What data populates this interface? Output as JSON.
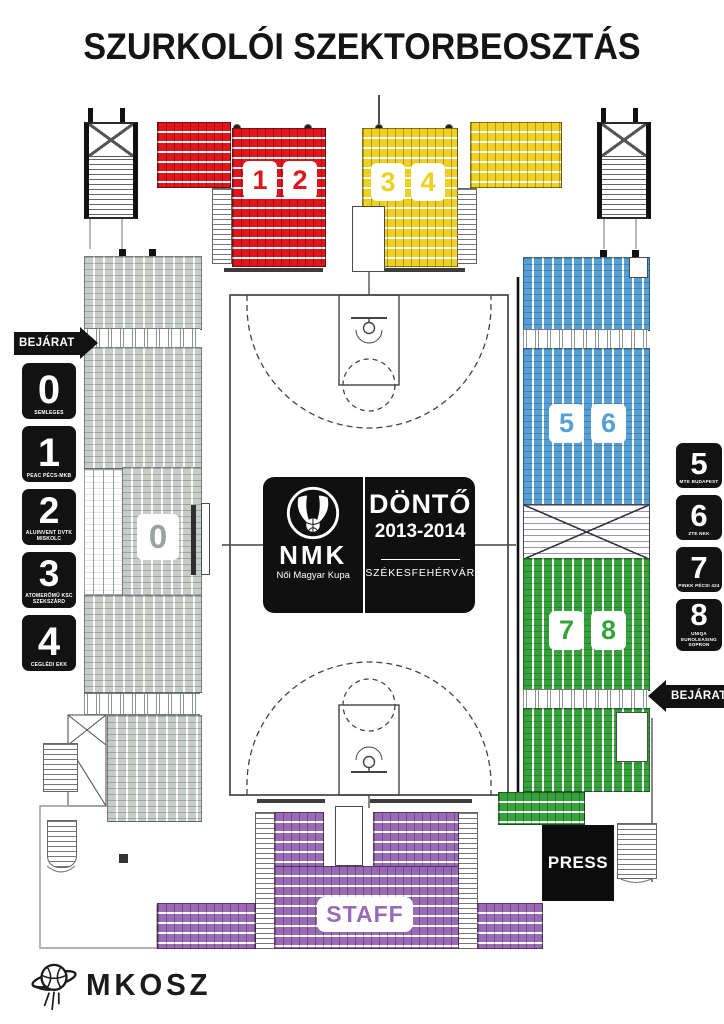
{
  "title": "SZURKOLÓI SZEKTORBEOSZTÁS",
  "labels": {
    "entrance_left": "BEJÁRAT",
    "entrance_right": "BEJÁRAT",
    "staff": "STAFF",
    "press": "PRESS"
  },
  "sectors": [
    {
      "number": "0",
      "team": "SEMLEGES",
      "color": "gray"
    },
    {
      "number": "1",
      "team": "PEAC PÉCS-MKB",
      "color": "red"
    },
    {
      "number": "2",
      "team": "ALUINVENT DVTK MISKOLC",
      "color": "red"
    },
    {
      "number": "3",
      "team": "ATOMERŐMŰ KSC SZEKSZÁRD",
      "color": "yellow"
    },
    {
      "number": "4",
      "team": "CEGLÉDI EKK",
      "color": "yellow"
    },
    {
      "number": "5",
      "team": "MTK BUDAPEST",
      "color": "blue"
    },
    {
      "number": "6",
      "team": "ZTE NKK",
      "color": "blue"
    },
    {
      "number": "7",
      "team": "PINKK PÉCSI 424",
      "color": "green"
    },
    {
      "number": "8",
      "team": "UNIQA EUROLEASING SOPRON",
      "color": "green"
    }
  ],
  "center_logo": {
    "abbr": "NMK",
    "name": "Női Magyar Kupa",
    "event": "DÖNTŐ",
    "season": "2013-2014",
    "city": "SZÉKESFEHÉRVÁR"
  },
  "footer": {
    "federation": "MKOSZ"
  },
  "colors": {
    "red": "#e0161c",
    "yellow": "#f0d01e",
    "blue": "#56a0d6",
    "green": "#35a23c",
    "purple": "#9a6ab5",
    "gray": "#c7cdc9",
    "gray_label": "#99a3a1",
    "ink": "#121212"
  }
}
